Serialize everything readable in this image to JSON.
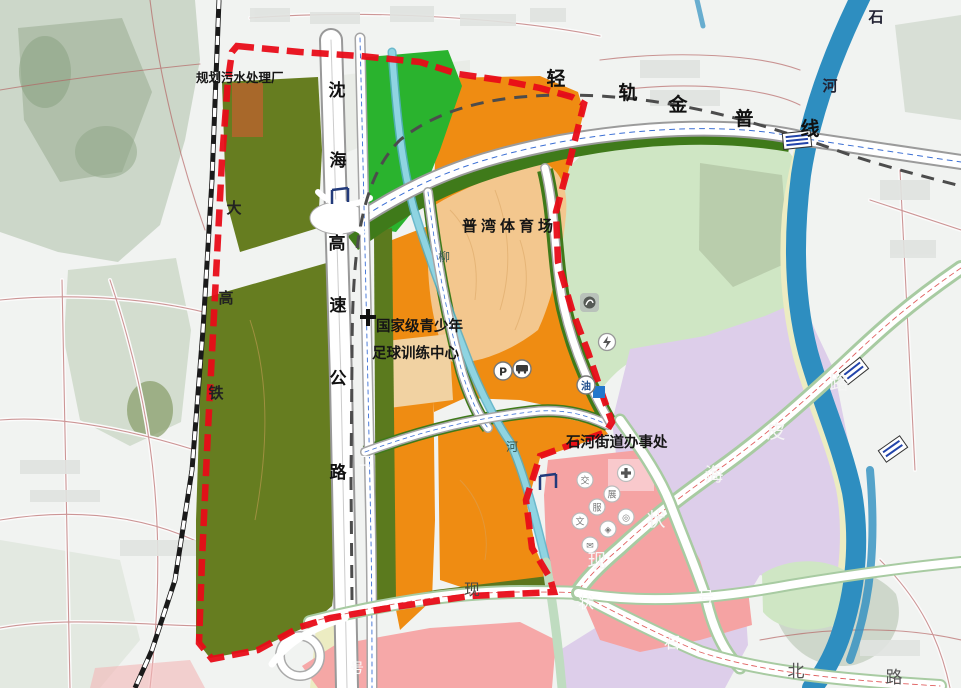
{
  "map": {
    "title": "urban-planning-map",
    "labels": {
      "sewage_plant": "规划污水处理厂",
      "stadium": "普湾体育场",
      "training_center_line1": "国家级青少年",
      "training_center_line2": "足球训练中心",
      "subdistrict_office": "石河街道办事处"
    },
    "road_chars": {
      "shenhai_expressway": [
        "沈",
        "海",
        "高",
        "速",
        "公",
        "路"
      ],
      "jinpu_light_rail": [
        "轻",
        "轨",
        "金",
        "普",
        "线"
      ],
      "high_speed_rail": [
        "大",
        "高",
        "铁"
      ],
      "shihe_river": [
        "石",
        "河"
      ],
      "liu_stream": [
        "柳",
        "河"
      ],
      "road_no2": [
        "二",
        "号"
      ],
      "haipi_road_existing": [
        "现",
        "状",
        "海",
        "皮",
        "路"
      ],
      "shihe_north_road_existing": [
        "现",
        "状",
        "号",
        "石",
        "北",
        "路"
      ]
    },
    "icons": {
      "parking": "P",
      "gas_station": "油",
      "facility_glyphs": [
        "交",
        "展",
        "服",
        "文"
      ]
    },
    "colors": {
      "boundary_red": "#e80c18",
      "zone_orange": "#ef8c12",
      "zone_olive": "#667d20",
      "zone_bright_green": "#2ab32e",
      "zone_light_green": "#cfe6c4",
      "zone_purple": "#ddceea",
      "zone_pink": "#f5a3a3",
      "zone_tan": "#f3c78e",
      "river_blue": "#2e8ec0",
      "railway_black": "#1a1a1a"
    }
  }
}
